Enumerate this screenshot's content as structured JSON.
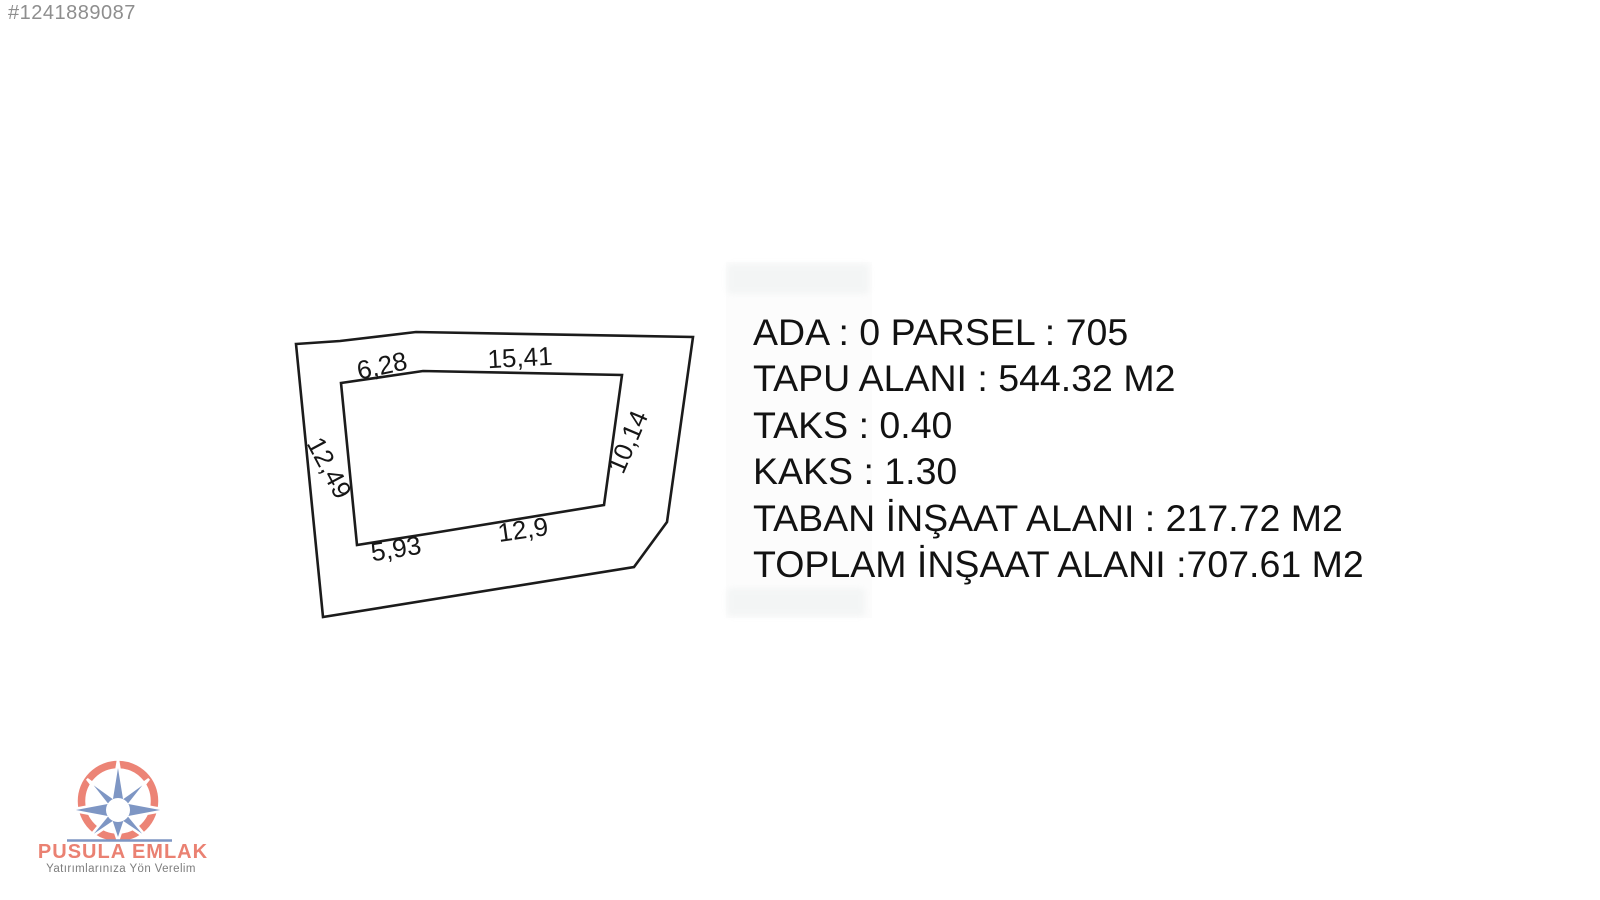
{
  "listing_id": "#1241889087",
  "colors": {
    "line": "#1b1b1b",
    "id_gray": "#8e8e8e",
    "logo_coral": "#ec8476",
    "logo_blue": "#7e96c4",
    "tagline_gray": "#7d7d7d"
  },
  "parcel_diagram": {
    "dimensions": {
      "top_left": "6,28",
      "top": "15,41",
      "left": "12,49",
      "right": "10,14",
      "bottom_left": "5,93",
      "bottom": "12,9"
    }
  },
  "info": {
    "lines": [
      "ADA : 0 PARSEL : 705",
      "TAPU ALANI : 544.32 M2",
      "TAKS : 0.40",
      "KAKS : 1.30",
      "TABAN İNŞAAT ALANI : 217.72 M2",
      "TOPLAM İNŞAAT ALANI :707.61 M2"
    ]
  },
  "logo": {
    "name": "PUSULA EMLAK",
    "tagline": "Yatırımlarınıza Yön Verelim"
  }
}
